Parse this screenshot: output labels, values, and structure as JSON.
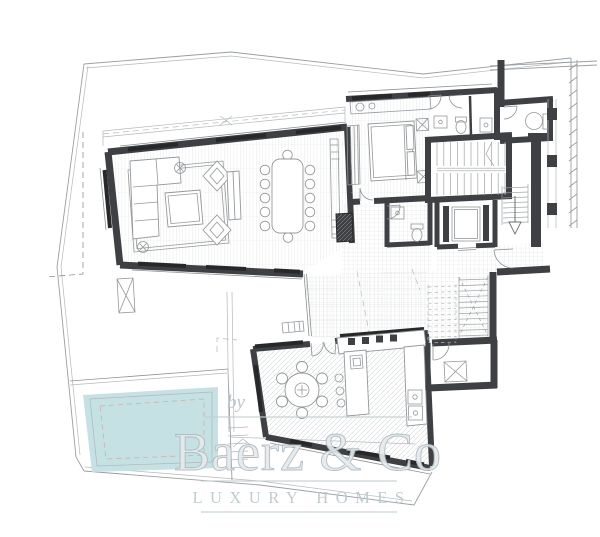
{
  "watermark": {
    "prefix": "by",
    "brand": "Baerz & Co",
    "tagline": "LUXURY HOMES"
  },
  "colors": {
    "paper": "#ffffff",
    "wall": "#3e4043",
    "thin-line": "#8d9194",
    "boundary": "#9a9ea1",
    "pool": "#c5e1e3",
    "watermark": "#bcc7cc",
    "watermark-fill": "#e6eaec",
    "watermark-stroke": "#aeb9bf"
  },
  "icons": {
    "pool": "swimming-pool",
    "stairs": "staircase",
    "elevator": "elevator-car",
    "arrow": "stair-direction-arrow"
  }
}
